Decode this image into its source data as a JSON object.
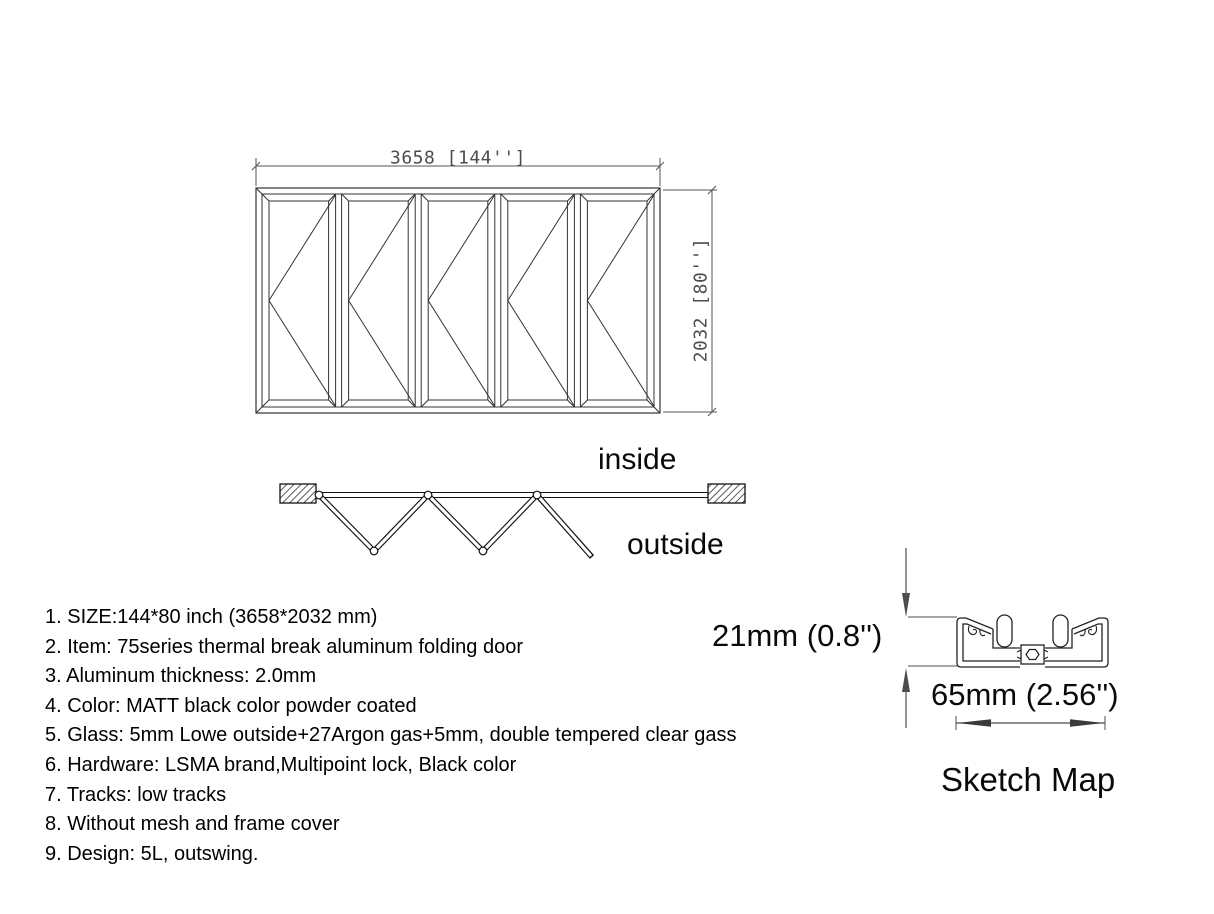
{
  "elevation": {
    "width_dim_label": "3658 [144'']",
    "height_dim_label": "2032 [80'']"
  },
  "plan": {
    "inside_label": "inside",
    "outside_label": "outside"
  },
  "specs": {
    "items": [
      "1. SIZE:144*80 inch (3658*2032 mm)",
      "2. Item: 75series thermal break aluminum folding door",
      "3. Aluminum thickness: 2.0mm",
      "4. Color: MATT black color powder coated",
      "5. Glass: 5mm Lowe outside+27Argon gas+5mm, double tempered clear gass",
      "6. Hardware: LSMA brand,Multipoint lock, Black color",
      "7. Tracks: low tracks",
      "8. Without mesh and frame cover",
      "9. Design: 5L, outswing."
    ]
  },
  "sketch": {
    "height_dim_label": "21mm (0.8'')",
    "width_dim_label": "65mm (2.56'')",
    "caption": "Sketch Map"
  },
  "colors": {
    "background": "#ffffff",
    "line": "#333333",
    "dim": "#4d4d4d",
    "text": "#000000"
  }
}
